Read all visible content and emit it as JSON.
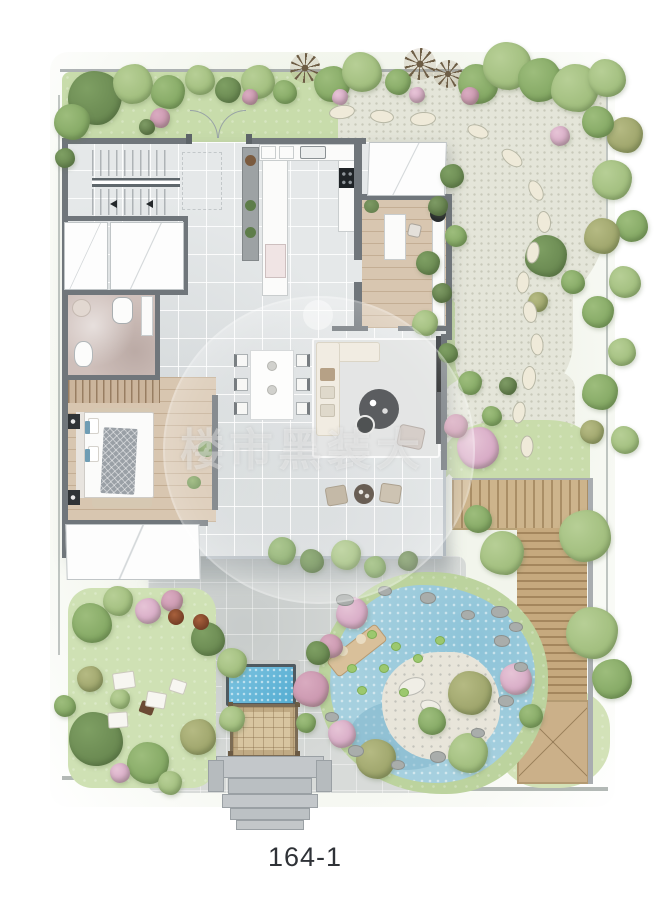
{
  "label": {
    "text": "164-1"
  },
  "watermark": {
    "text": "楼市黑装大"
  },
  "palette": {
    "wall": "#70767b",
    "tile": "#e5e8e9",
    "wood": "#d8c6b0",
    "bath_floor": "#cfc0bb",
    "lawn": "#c8dcab",
    "gravel": "#e4e5d9",
    "paving": "#d8dbd9",
    "pond_water": "#a6d0df",
    "pool_water": "#5fb7dc",
    "deck_wood": "#c6a97e",
    "sand": "#e8e5da",
    "trees": {
      "g1": [
        "#9dbd7c",
        "#7fa45f"
      ],
      "g2": [
        "#b7cf96",
        "#9cba78"
      ],
      "g3": [
        "#7e9f63",
        "#66854e"
      ],
      "pk": [
        "#e6c4d6",
        "#d3a3c1"
      ],
      "pk2": [
        "#d9abc0",
        "#c792ab"
      ],
      "ol": [
        "#b5ba83",
        "#99a066"
      ],
      "br": [
        "#9b8a6c",
        "#6d5d45"
      ],
      "dk": [
        "#7d9a64",
        "#5f7a48"
      ]
    }
  },
  "garden": {
    "trees": [
      [
        95,
        98,
        27,
        "g3"
      ],
      [
        133,
        84,
        20,
        "g2"
      ],
      [
        168,
        92,
        17,
        "g1"
      ],
      [
        200,
        80,
        15,
        "g2"
      ],
      [
        228,
        90,
        13,
        "g3"
      ],
      [
        258,
        82,
        17,
        "g2"
      ],
      [
        250,
        97,
        8,
        "pk2"
      ],
      [
        285,
        92,
        12,
        "g1"
      ],
      [
        305,
        68,
        15,
        "br"
      ],
      [
        332,
        84,
        18,
        "g1"
      ],
      [
        340,
        97,
        8,
        "pk"
      ],
      [
        362,
        72,
        20,
        "g2"
      ],
      [
        398,
        82,
        13,
        "g1"
      ],
      [
        420,
        64,
        16,
        "br"
      ],
      [
        448,
        74,
        14,
        "br"
      ],
      [
        478,
        84,
        20,
        "g1"
      ],
      [
        507,
        66,
        24,
        "g2"
      ],
      [
        540,
        80,
        22,
        "g1"
      ],
      [
        575,
        88,
        24,
        "g2"
      ],
      [
        607,
        78,
        19,
        "g2"
      ],
      [
        470,
        96,
        9,
        "pk2"
      ],
      [
        417,
        95,
        8,
        "pk"
      ],
      [
        160,
        118,
        10,
        "pk2"
      ],
      [
        147,
        127,
        8,
        "dk"
      ],
      [
        72,
        122,
        18,
        "g1"
      ],
      [
        65,
        158,
        10,
        "g3"
      ],
      [
        625,
        135,
        18,
        "ol"
      ],
      [
        598,
        122,
        16,
        "g1"
      ],
      [
        612,
        180,
        20,
        "g2"
      ],
      [
        632,
        226,
        16,
        "g1"
      ],
      [
        602,
        236,
        18,
        "ol"
      ],
      [
        625,
        282,
        16,
        "g2"
      ],
      [
        598,
        312,
        16,
        "g1"
      ],
      [
        622,
        352,
        14,
        "g2"
      ],
      [
        600,
        392,
        18,
        "g1"
      ],
      [
        625,
        440,
        14,
        "g2"
      ],
      [
        592,
        432,
        12,
        "ol"
      ],
      [
        560,
        136,
        10,
        "pk"
      ],
      [
        546,
        256,
        21,
        "g3"
      ],
      [
        573,
        282,
        12,
        "g1"
      ],
      [
        538,
        302,
        10,
        "ol"
      ],
      [
        452,
        176,
        12,
        "g3"
      ],
      [
        438,
        206,
        10,
        "dk"
      ],
      [
        456,
        236,
        11,
        "g1"
      ],
      [
        428,
        263,
        12,
        "g3"
      ],
      [
        442,
        293,
        10,
        "dk"
      ],
      [
        425,
        323,
        13,
        "g2"
      ],
      [
        448,
        353,
        10,
        "g3"
      ],
      [
        470,
        383,
        12,
        "g1"
      ],
      [
        478,
        448,
        21,
        "pk"
      ],
      [
        456,
        426,
        12,
        "pk2"
      ],
      [
        492,
        416,
        10,
        "g1"
      ],
      [
        508,
        386,
        9,
        "dk"
      ],
      [
        585,
        536,
        26,
        "g2"
      ],
      [
        502,
        553,
        22,
        "g2"
      ],
      [
        478,
        519,
        14,
        "g1"
      ],
      [
        592,
        633,
        26,
        "g2"
      ],
      [
        612,
        679,
        20,
        "g1"
      ],
      [
        352,
        613,
        16,
        "pk"
      ],
      [
        331,
        646,
        12,
        "pk2"
      ],
      [
        470,
        693,
        22,
        "ol"
      ],
      [
        516,
        679,
        16,
        "pk"
      ],
      [
        468,
        753,
        20,
        "g2"
      ],
      [
        432,
        721,
        14,
        "g1"
      ],
      [
        376,
        759,
        20,
        "ol"
      ],
      [
        342,
        734,
        14,
        "pk"
      ],
      [
        311,
        689,
        18,
        "pk2"
      ],
      [
        318,
        653,
        12,
        "g3"
      ],
      [
        306,
        723,
        10,
        "g1"
      ],
      [
        531,
        716,
        12,
        "g1"
      ],
      [
        282,
        551,
        14,
        "g1"
      ],
      [
        312,
        561,
        12,
        "g3"
      ],
      [
        346,
        555,
        15,
        "g2"
      ],
      [
        375,
        567,
        11,
        "g1"
      ],
      [
        408,
        561,
        10,
        "dk"
      ],
      [
        92,
        623,
        20,
        "g1"
      ],
      [
        118,
        601,
        15,
        "g2"
      ],
      [
        148,
        611,
        13,
        "pk"
      ],
      [
        172,
        601,
        11,
        "pk2"
      ],
      [
        208,
        639,
        17,
        "g3"
      ],
      [
        232,
        663,
        15,
        "g2"
      ],
      [
        90,
        679,
        13,
        "ol"
      ],
      [
        120,
        699,
        10,
        "g2"
      ],
      [
        96,
        739,
        27,
        "g3"
      ],
      [
        148,
        763,
        21,
        "g1"
      ],
      [
        198,
        737,
        18,
        "ol"
      ],
      [
        232,
        719,
        13,
        "g2"
      ],
      [
        65,
        706,
        11,
        "g1"
      ],
      [
        170,
        783,
        12,
        "g2"
      ],
      [
        120,
        773,
        10,
        "pk"
      ]
    ],
    "stepping_stones": [
      [
        342,
        112,
        26,
        14,
        -8
      ],
      [
        382,
        116,
        24,
        13,
        6
      ],
      [
        423,
        119,
        26,
        14,
        -4
      ],
      [
        478,
        131,
        22,
        13,
        20
      ],
      [
        512,
        158,
        24,
        14,
        38
      ],
      [
        536,
        190,
        22,
        13,
        62
      ],
      [
        544,
        222,
        22,
        14,
        85
      ],
      [
        533,
        252,
        22,
        13,
        100
      ],
      [
        523,
        282,
        22,
        13,
        95
      ],
      [
        530,
        312,
        22,
        14,
        80
      ],
      [
        537,
        344,
        22,
        13,
        85
      ],
      [
        529,
        378,
        24,
        14,
        95
      ],
      [
        519,
        412,
        22,
        13,
        100
      ],
      [
        527,
        446,
        22,
        13,
        92
      ]
    ],
    "rocks": [
      [
        345,
        600,
        9
      ],
      [
        385,
        591,
        7
      ],
      [
        428,
        598,
        8
      ],
      [
        468,
        615,
        7
      ],
      [
        502,
        641,
        8
      ],
      [
        521,
        667,
        7
      ],
      [
        506,
        701,
        8
      ],
      [
        478,
        733,
        7
      ],
      [
        438,
        757,
        8
      ],
      [
        398,
        765,
        7
      ],
      [
        356,
        751,
        8
      ],
      [
        332,
        717,
        7
      ],
      [
        500,
        612,
        9
      ],
      [
        516,
        627,
        7
      ]
    ],
    "lily_pads": [
      [
        372,
        634
      ],
      [
        396,
        646
      ],
      [
        384,
        668
      ],
      [
        418,
        658
      ],
      [
        362,
        690
      ],
      [
        440,
        640
      ],
      [
        404,
        692
      ],
      [
        352,
        668
      ]
    ],
    "picnic_blankets": [
      [
        124,
        680,
        22,
        17,
        -8
      ],
      [
        156,
        700,
        20,
        16,
        10
      ],
      [
        118,
        720,
        20,
        16,
        -4
      ],
      [
        178,
        686,
        16,
        13,
        18
      ]
    ],
    "planter_pots": [
      [
        176,
        617,
        8
      ],
      [
        201,
        622,
        8
      ]
    ]
  }
}
